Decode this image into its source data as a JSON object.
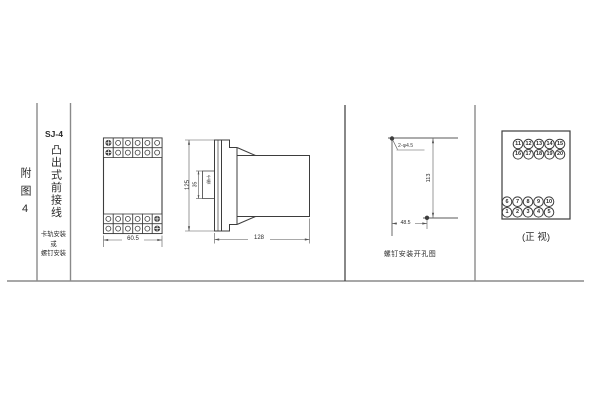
{
  "colors": {
    "line": "#3d3d3d",
    "frame": "#8a8a8a",
    "dim": "#555555",
    "text": "#2b2b2b",
    "background": "#ffffff"
  },
  "sidebar": {
    "figure_label": "附图4",
    "model": "SJ-4",
    "model_type": "凸出式前接线",
    "mount_lines": [
      "卡轨安装",
      "或",
      "螺钉安装"
    ]
  },
  "front_view": {
    "width_dim": "60.5"
  },
  "side_view": {
    "height_dim": "125",
    "depth_dim": "128",
    "slot_dim": "35",
    "slot_label": "卡槽"
  },
  "drill_view": {
    "holes_label": "2-φ4.5",
    "height_dim": "113",
    "width_dim": "48.5",
    "caption": "螺钉安装开孔图"
  },
  "terminal_view": {
    "caption": "(正 视)",
    "top_group": [
      [
        "11",
        "12",
        "13",
        "14",
        "15"
      ],
      [
        "16",
        "17",
        "18",
        "19",
        "20"
      ]
    ],
    "bottom_group": [
      [
        "6",
        "7",
        "8",
        "9",
        "10"
      ],
      [
        "1",
        "2",
        "3",
        "4",
        "5"
      ]
    ]
  }
}
